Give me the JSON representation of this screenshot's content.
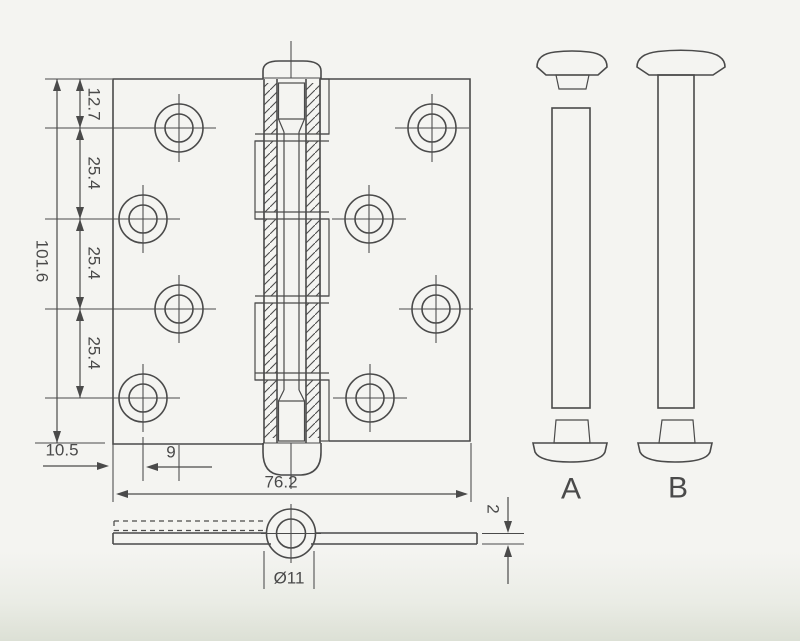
{
  "colors": {
    "line": "#4a4a4a",
    "paper": "#f4f4f1"
  },
  "front_view": {
    "dims": {
      "top_offset": "12.7",
      "pitches": [
        "25.4",
        "25.4",
        "25.4"
      ],
      "total_height": "101.6",
      "edge_offset": "10.5",
      "hole_stagger": "9",
      "total_width": "76.2"
    }
  },
  "side_view": {
    "dims": {
      "knuckle_diameter": "Ø11",
      "leaf_thickness": "2"
    }
  },
  "pins": {
    "pin_a_label": "A",
    "pin_b_label": "B"
  }
}
